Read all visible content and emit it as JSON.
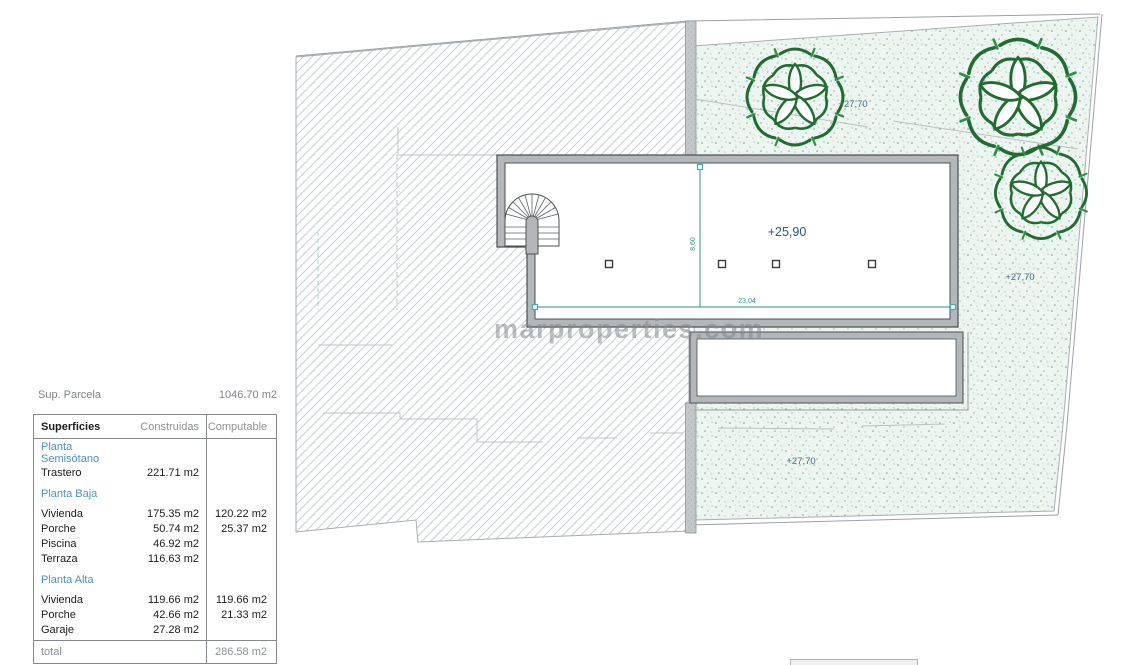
{
  "watermark": {
    "text": "marproperties.com"
  },
  "summary": {
    "parcel_label": "Sup. Parcela",
    "parcel_value": "1046.70 m2"
  },
  "table": {
    "headers": {
      "col1": "Superficies",
      "col2": "Construidas",
      "col3": "Computable"
    },
    "sections": [
      {
        "title": "Planta Semisótano",
        "rows": [
          {
            "label": "Trastero",
            "construidas": "221.71 m2",
            "computable": ""
          }
        ]
      },
      {
        "title": "Planta Baja",
        "rows": [
          {
            "label": "Vivienda",
            "construidas": "175.35 m2",
            "computable": "120.22 m2"
          },
          {
            "label": "Porche",
            "construidas": "50.74 m2",
            "computable": "25.37 m2"
          },
          {
            "label": "Piscina",
            "construidas": "46.92 m2",
            "computable": ""
          },
          {
            "label": "Terraza",
            "construidas": "116.63 m2",
            "computable": ""
          }
        ]
      },
      {
        "title": "Planta Alta",
        "rows": [
          {
            "label": "Vivienda",
            "construidas": "119.66 m2",
            "computable": "119.66 m2"
          },
          {
            "label": "Porche",
            "construidas": "42.66 m2",
            "computable": "21.33 m2"
          },
          {
            "label": "Garaje",
            "construidas": "27.28 m2",
            "computable": ""
          }
        ]
      }
    ],
    "total": {
      "label": "total",
      "value": "286.58 m2"
    }
  },
  "plan": {
    "labels": {
      "level_main": "+25,90",
      "level_top": "+27,70",
      "level_right": "+27,70",
      "level_bottom": "+27,70",
      "dim_horizontal": "23,04",
      "dim_vertical": "8,60"
    },
    "colors": {
      "dimension_teal": "#2f8e8e",
      "level_label_blue": "#1f5c79",
      "tree_green": "#206d30",
      "wall_gray": "#b4b7ba",
      "section_blue": "#4a93ba"
    }
  }
}
